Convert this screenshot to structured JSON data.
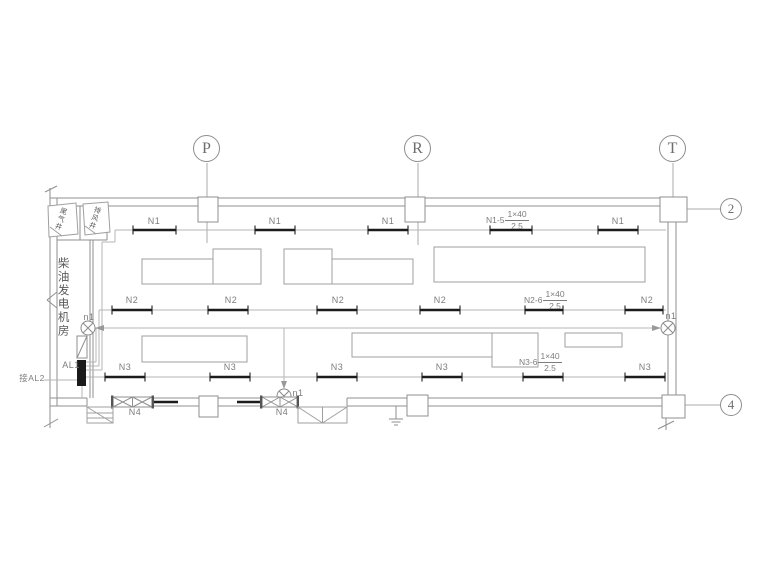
{
  "colors": {
    "wall_line": "#8f8f8f",
    "thin_circuit_line": "#b5b5b5",
    "thick_circuit_line": "#1c1c1c",
    "label_text": "#7d7d7d",
    "cjk_text": "#5a5a5a",
    "panel_fill": "#1a1a1a",
    "background": "#ffffff"
  },
  "grid": {
    "columns": [
      {
        "label": "P"
      },
      {
        "label": "R"
      },
      {
        "label": "T"
      }
    ],
    "rows": [
      {
        "label": "2"
      },
      {
        "label": "4"
      }
    ]
  },
  "rooms": {
    "main_room_name": "柴油发电机房",
    "shaft_left_name": "尾气井",
    "shaft_right_name": "排风井"
  },
  "power": {
    "panel_name": "AL1",
    "incoming_note": "接AL2",
    "lamp_code": "n1"
  },
  "circuits": {
    "n1": {
      "code": "N1",
      "feeder_code": "N1-5",
      "feeder_spec_num": "1×40",
      "feeder_spec_den": "2.5"
    },
    "n2": {
      "code": "N2",
      "feeder_code": "N2-6",
      "feeder_spec_num": "1×40",
      "feeder_spec_den": "2.5"
    },
    "n3": {
      "code": "N3",
      "feeder_code": "N3-6",
      "feeder_spec_num": "1×40",
      "feeder_spec_den": "2.5"
    },
    "n4": {
      "code": "N4"
    }
  },
  "symbols": {
    "lamp": "circle-with-cross ⊗",
    "fan_louver": "rect with X bracing",
    "ground": "earth ground bars",
    "door": "leaf with diagonal swing"
  }
}
